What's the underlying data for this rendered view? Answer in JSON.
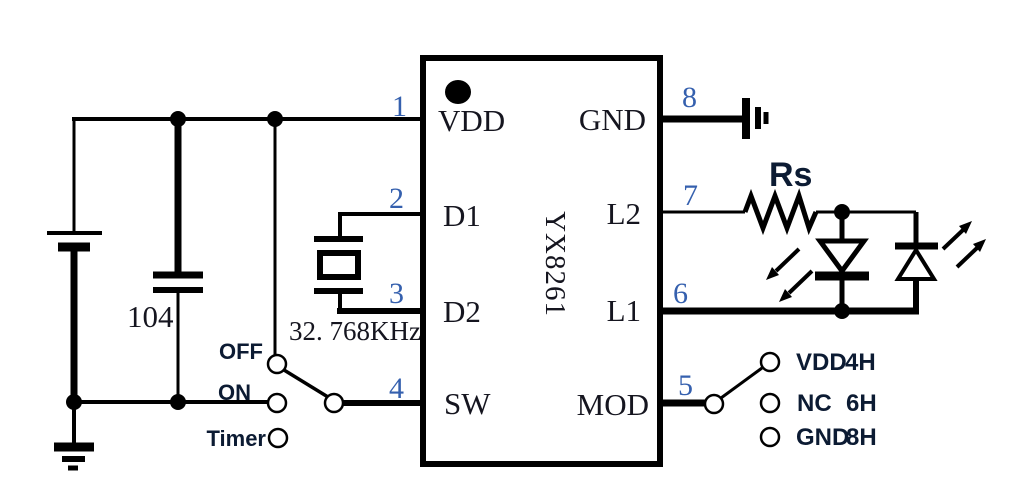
{
  "diagram": {
    "ic": {
      "part_number": "YX8261",
      "pins_left": [
        {
          "number": "1",
          "name": "VDD"
        },
        {
          "number": "2",
          "name": "D1"
        },
        {
          "number": "3",
          "name": "D2"
        },
        {
          "number": "4",
          "name": "SW"
        }
      ],
      "pins_right": [
        {
          "number": "8",
          "name": "GND"
        },
        {
          "number": "7",
          "name": "L2"
        },
        {
          "number": "6",
          "name": "L1"
        },
        {
          "number": "5",
          "name": "MOD"
        }
      ]
    },
    "components": {
      "capacitor": {
        "value": "104"
      },
      "crystal": {
        "frequency": "32. 768KHz"
      },
      "resistor": {
        "label": "Rs"
      },
      "battery": {
        "type": "cell"
      },
      "led1": {
        "type": "LED emitting down-left"
      },
      "led2": {
        "type": "LED emitting up-right"
      }
    },
    "power_switch": {
      "positions": [
        {
          "label": "OFF"
        },
        {
          "label": "ON"
        },
        {
          "label": "Timer"
        }
      ]
    },
    "mode_switch": {
      "options": [
        {
          "label": "VDD",
          "mode": "4H"
        },
        {
          "label": "NC",
          "mode": "6H"
        },
        {
          "label": "GND",
          "mode": "8H"
        }
      ]
    },
    "colors": {
      "line": "#000000",
      "pin_number": "#3560ae",
      "bold_label": "#0c1b33",
      "background": "#ffffff"
    }
  }
}
